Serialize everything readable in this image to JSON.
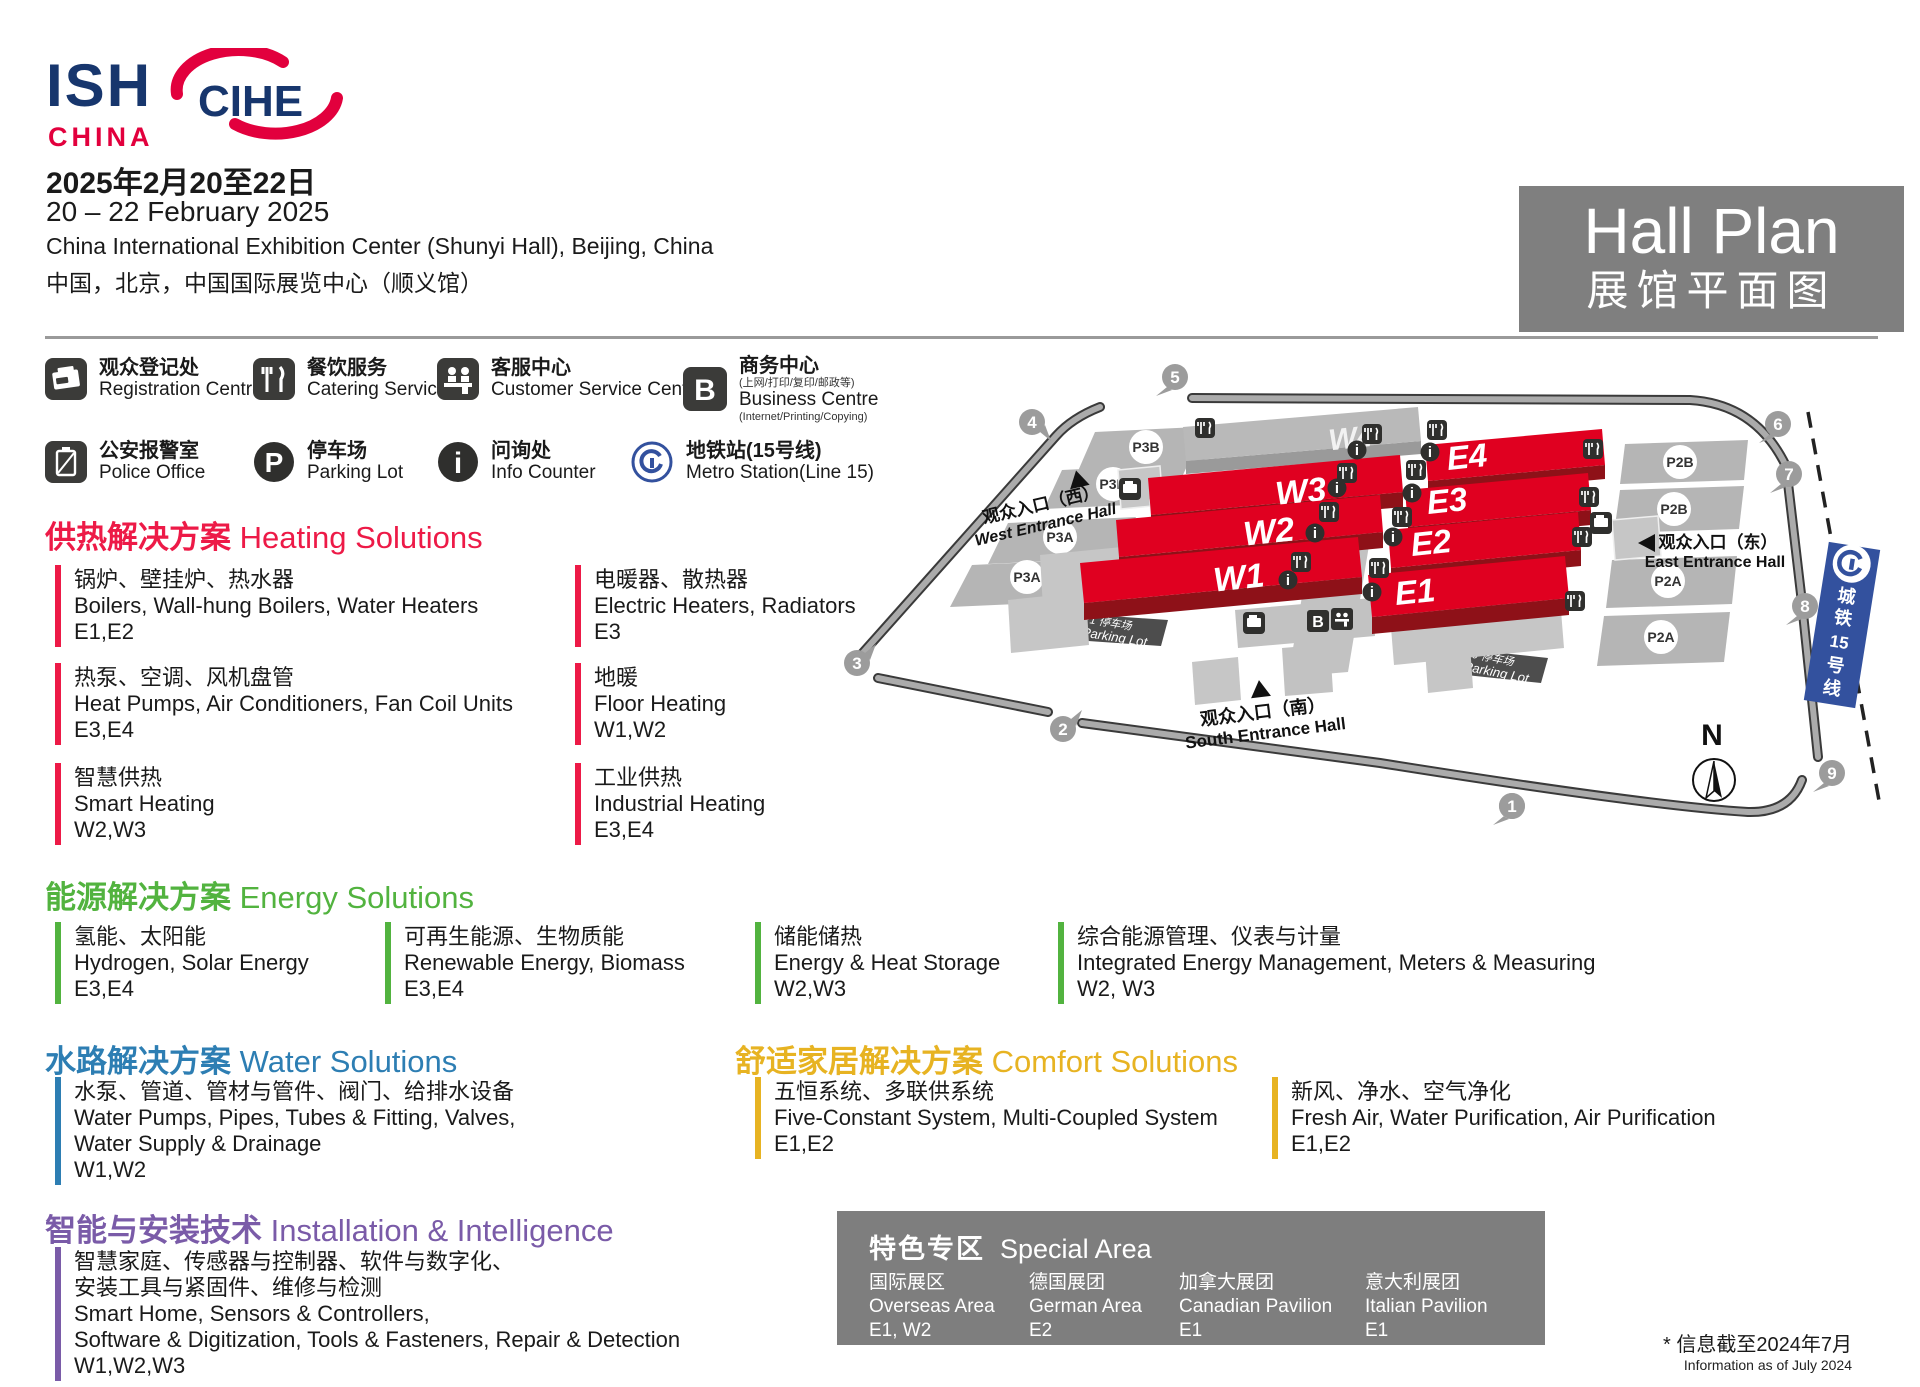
{
  "header": {
    "logo_ish": "ISH",
    "logo_china": "CHINA",
    "logo_cihe": "CIHE",
    "date_zh": "2025年2月20至22日",
    "date_en": "20 – 22 February 2025",
    "venue_en": "China International Exhibition Center (Shunyi Hall), Beijing, China",
    "venue_zh": "中国，北京，中国国际展览中心（顺义馆）",
    "hallplan_en": "Hall Plan",
    "hallplan_zh": "展馆平面图"
  },
  "legend": {
    "items": [
      {
        "zh": "观众登记处",
        "en": "Registration Centre"
      },
      {
        "zh": "餐饮服务",
        "en": "Catering Service"
      },
      {
        "zh": "客服中心",
        "en": "Customer Service Centre"
      },
      {
        "zh": "商务中心",
        "sub_zh": "(上网/打印/复印/邮政等)",
        "en": "Business Centre",
        "sub_en": "(Internet/Printing/Copying)"
      },
      {
        "zh": "公安报警室",
        "en": "Police Office"
      },
      {
        "zh": "停车场",
        "en": "Parking Lot"
      },
      {
        "zh": "问询处",
        "en": "Info Counter"
      },
      {
        "zh": "地铁站(15号线)",
        "en": "Metro Station(Line 15)"
      }
    ]
  },
  "sections": {
    "heating": {
      "title_zh": "供热解决方案",
      "title_en": "Heating Solutions",
      "color": "#ed1a47",
      "items": [
        {
          "zh": "锅炉、壁挂炉、热水器",
          "en": "Boilers, Wall-hung Boilers, Water Heaters",
          "halls": "E1,E2"
        },
        {
          "zh": "电暖器、散热器",
          "en": "Electric Heaters, Radiators",
          "halls": "E3"
        },
        {
          "zh": "热泵、空调、风机盘管",
          "en": "Heat Pumps, Air Conditioners, Fan Coil Units",
          "halls": "E3,E4"
        },
        {
          "zh": "地暖",
          "en": "Floor Heating",
          "halls": "W1,W2"
        },
        {
          "zh": "智慧供热",
          "en": "Smart Heating",
          "halls": "W2,W3"
        },
        {
          "zh": "工业供热",
          "en": "Industrial Heating",
          "halls": "E3,E4"
        }
      ]
    },
    "energy": {
      "title_zh": "能源解决方案",
      "title_en": "Energy Solutions",
      "color": "#52b33f",
      "items": [
        {
          "zh": "氢能、太阳能",
          "en": "Hydrogen, Solar Energy",
          "halls": "E3,E4"
        },
        {
          "zh": "可再生能源、生物质能",
          "en": "Renewable Energy, Biomass",
          "halls": "E3,E4"
        },
        {
          "zh": "储能储热",
          "en": "Energy & Heat Storage",
          "halls": "W2,W3"
        },
        {
          "zh": "综合能源管理、仪表与计量",
          "en": "Integrated Energy Management, Meters & Measuring",
          "halls": "W2, W3"
        }
      ]
    },
    "water": {
      "title_zh": "水路解决方案",
      "title_en": "Water Solutions",
      "color": "#2d7eb3",
      "items": [
        {
          "zh": "水泵、管道、管材与管件、阀门、给排水设备",
          "en": "Water Pumps, Pipes, Tubes & Fitting, Valves,",
          "en2": "Water Supply & Drainage",
          "halls": "W1,W2"
        }
      ]
    },
    "comfort": {
      "title_zh": "舒适家居解决方案",
      "title_en": "Comfort Solutions",
      "color": "#e7b322",
      "items": [
        {
          "zh": "五恒系统、多联供系统",
          "en": "Five-Constant System, Multi-Coupled System",
          "halls": "E1,E2"
        },
        {
          "zh": "新风、净水、空气净化",
          "en": "Fresh Air, Water Purification, Air Purification",
          "halls": "E1,E2"
        }
      ]
    },
    "install": {
      "title_zh": "智能与安装技术",
      "title_en": "Installation & Intelligence",
      "color": "#7a5ba8",
      "items": [
        {
          "zh": "智慧家庭、传感器与控制器、软件与数字化、",
          "zh2": "安装工具与紧固件、维修与检测",
          "en": "Smart Home, Sensors & Controllers,",
          "en2": "Software & Digitization, Tools & Fasteners, Repair & Detection",
          "halls": "W1,W2,W3"
        }
      ]
    }
  },
  "special": {
    "title_zh": "特色专区",
    "title_en": "Special Area",
    "items": [
      {
        "zh": "国际展区",
        "en": "Overseas Area",
        "halls": "E1, W2"
      },
      {
        "zh": "德国展团",
        "en": "German Area",
        "halls": "E2"
      },
      {
        "zh": "加拿大展团",
        "en": "Canadian Pavilion",
        "halls": "E1"
      },
      {
        "zh": "意大利展团",
        "en": "Italian Pavilion",
        "halls": "E1"
      }
    ]
  },
  "footnote": {
    "zh": "* 信息截至2024年7月",
    "en": "Information as of July 2024"
  },
  "map": {
    "halls": {
      "w1": "W1",
      "w2": "W2",
      "w3": "W3",
      "w4": "W4",
      "e1": "E1",
      "e2": "E2",
      "e3": "E3",
      "e4": "E4"
    },
    "parking": {
      "p3b": "P3B",
      "p3a": "P3A",
      "p2b": "P2B",
      "p2a": "P2A",
      "p1_zh": "P1 停车场",
      "p1_en": "P1 Parking Lot",
      "p0_zh": "P0 停车场",
      "p0_en": "P0 Parking Lot"
    },
    "entrances": {
      "west_zh": "观众入口（西）",
      "west_en": "West Entrance Hall",
      "east_zh": "观众入口（东）",
      "east_en": "East Entrance Hall",
      "south_zh": "观众入口（南）",
      "south_en": "South Entrance Hall"
    },
    "gates": [
      "1",
      "2",
      "3",
      "4",
      "5",
      "6",
      "7",
      "8",
      "9"
    ],
    "metro": [
      "城",
      "铁",
      "15",
      "号",
      "线"
    ],
    "north": "N"
  }
}
